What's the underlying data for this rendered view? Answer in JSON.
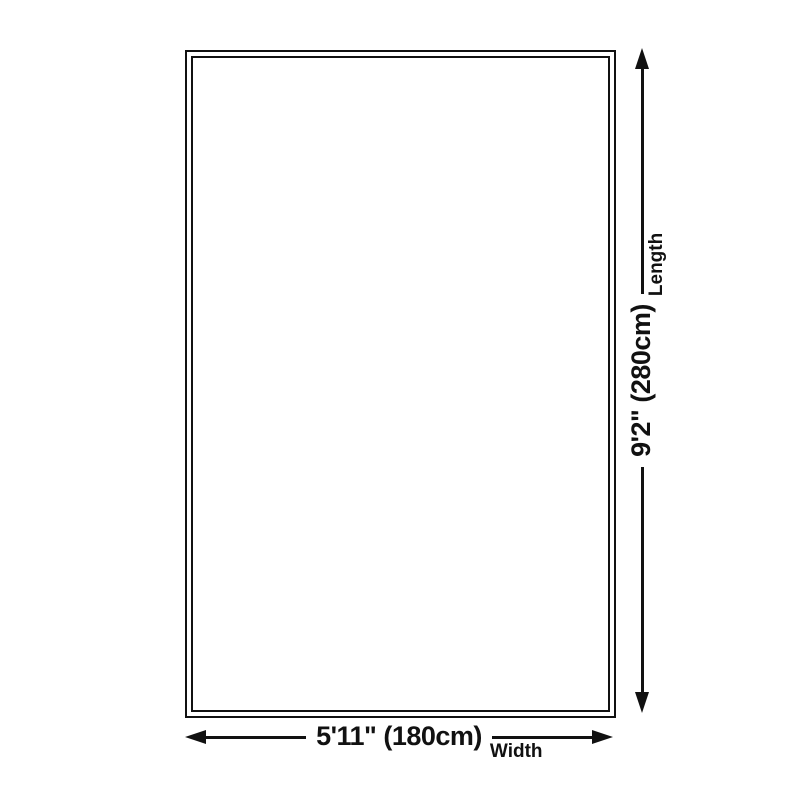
{
  "page": {
    "background_color": "#ffffff",
    "ink_color": "#111111"
  },
  "diagram": {
    "dimensions": {
      "width": {
        "value": "5'11\" (180cm)",
        "label": "Width"
      },
      "length": {
        "value": "9'2\" (280cm)",
        "label": "Length"
      }
    },
    "icons": {
      "arrow_left": "◀",
      "arrow_right": "▶",
      "arrow_up": "▲",
      "arrow_down": "▼"
    }
  }
}
